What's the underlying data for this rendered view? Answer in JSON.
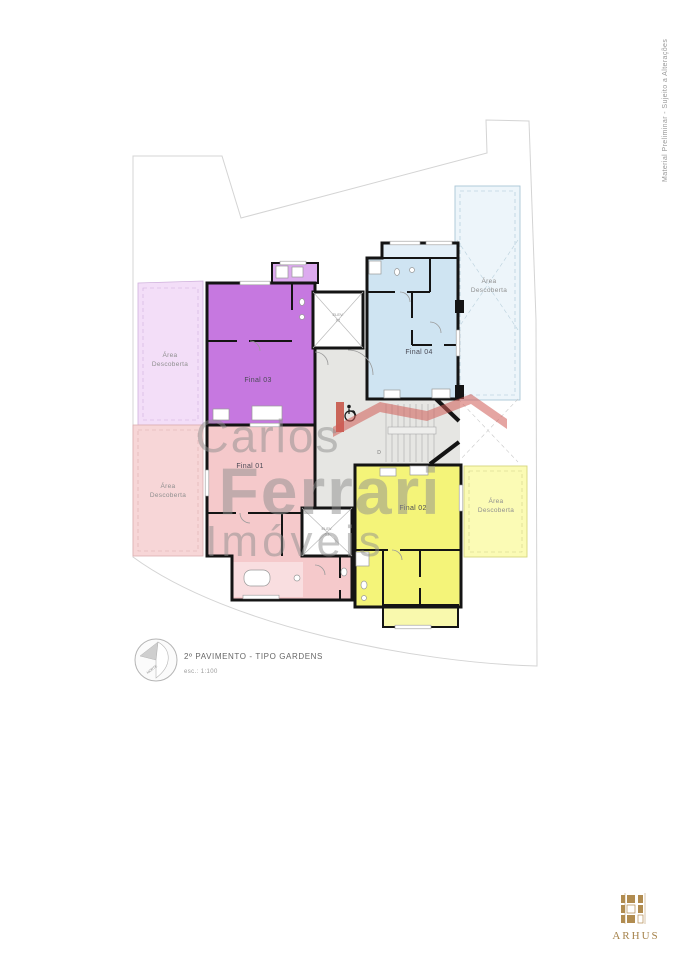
{
  "document": {
    "side_note": "Material Preliminar - Sujeito a Alterações"
  },
  "title_block": {
    "floor_title": "2º PAVIMENTO - TIPO GARDENS",
    "scale": "esc.: 1:100",
    "north_label": "NORTE"
  },
  "watermark": {
    "line1": "Carlos",
    "line2": "Ferrari",
    "line3": "Imóveis",
    "text_color": "#8f8f8f",
    "roof_color": "#cf5b55",
    "chimney_color": "#c0392b"
  },
  "plan": {
    "wall_color": "#141414",
    "units": [
      {
        "id": "final-01",
        "label": "Final 01",
        "fill": "#f5c9cb",
        "balcony_fill": "#f9dee0",
        "area_fill": "#f7d6d7",
        "area_border": "#dcaeb0"
      },
      {
        "id": "final-02",
        "label": "Final 02",
        "fill": "#f4f479",
        "balcony_fill": "#f9f9ad",
        "area_fill": "#fbfbb5",
        "area_border": "#d6d67e"
      },
      {
        "id": "final-03",
        "label": "Final 03",
        "fill": "#c678e0",
        "balcony_fill": "#dcaaef",
        "area_fill": "#f3def8",
        "area_border": "#cfb0dc"
      },
      {
        "id": "final-04",
        "label": "Final 04",
        "fill": "#cfe4f2",
        "balcony_fill": "#e3eff8",
        "area_fill": "#edf5fa",
        "area_border": "#a9c6d6"
      }
    ],
    "area_label": {
      "line1": "Área",
      "line2": "Descoberta"
    },
    "elevators": [
      {
        "id": "elev-02",
        "line1": "ELEV.",
        "line2": "02"
      },
      {
        "id": "elev-01",
        "line1": "ELEV.",
        "line2": "01"
      }
    ],
    "stairs": {
      "direction_label": "D"
    }
  },
  "branding": {
    "logo_text": "ARHUS",
    "logo_color": "#a5824b"
  }
}
